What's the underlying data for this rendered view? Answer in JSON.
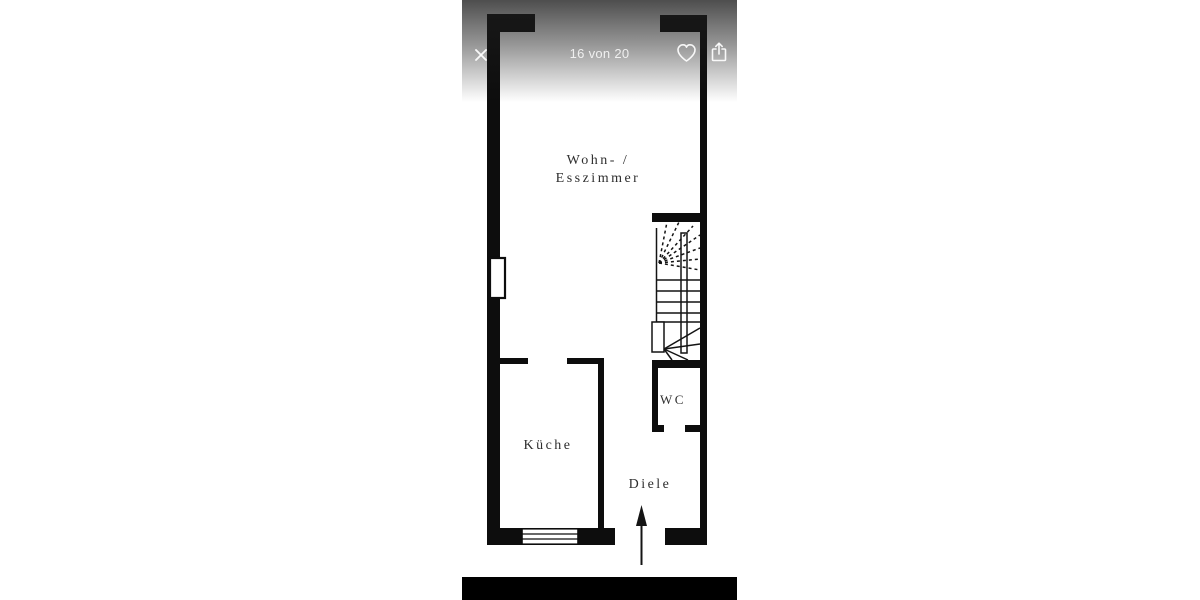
{
  "viewer": {
    "counter_label": "16 von 20",
    "icons": {
      "close": "close-icon",
      "favorite": "heart-icon",
      "share": "share-icon"
    },
    "colors": {
      "overlay_top": "rgba(28,28,28,0.78)",
      "bottom_bar": "#000000",
      "icon_color": "#ffffff",
      "counter_text": "rgba(255,255,255,0.82)"
    }
  },
  "floorplan": {
    "labels": {
      "living_line1": "Wohn- /",
      "living_line2": "Esszimmer",
      "kitchen": "Küche",
      "wc": "WC",
      "hall": "Diele"
    },
    "features": [
      "staircase",
      "entrance-arrow",
      "kitchen-window",
      "chimney"
    ],
    "colors": {
      "wall": "#0d0d0d",
      "floor": "#ffffff",
      "label_text": "#2e2e2e"
    }
  }
}
